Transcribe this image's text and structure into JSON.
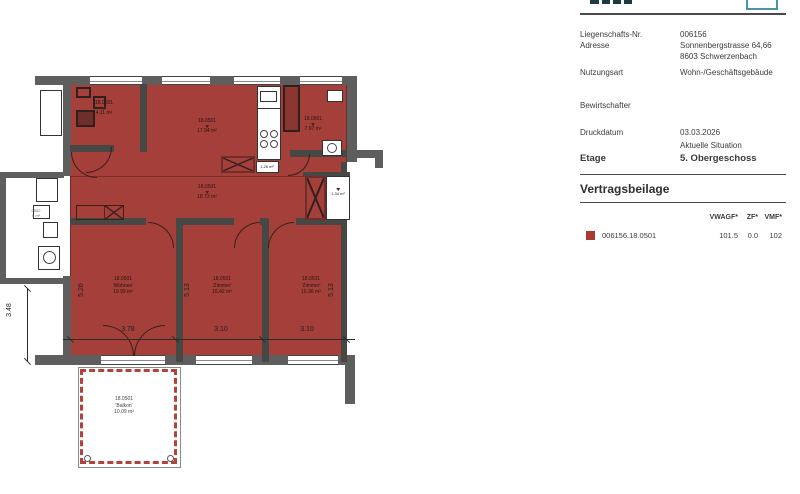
{
  "document": {
    "header": {
      "fields": [
        {
          "label": "Liegenschafts-Nr.",
          "value": "006156",
          "value2": ""
        },
        {
          "label": "Adresse",
          "value": "Sonnenbergstrasse 64,66",
          "value2": "8603 Schwerzenbach"
        },
        {
          "label": "Nutzungsart",
          "value": "Wohn-/Geschäftsgebäude",
          "value2": ""
        },
        {
          "label": "Bewirtschafter",
          "value": "",
          "value2": ""
        },
        {
          "label": "Druckdatum",
          "value": "03.03.2026",
          "value2": "Aktuelle Situation"
        }
      ],
      "etage_label": "Etage",
      "etage_value": "5. Obergeschoss"
    },
    "section_title": "Vertragsbeilage",
    "table": {
      "headers": {
        "vwagf": "VWAGF*",
        "zf": "ZF*",
        "vmf": "VMF*"
      },
      "row": {
        "id": "006156.18.0501",
        "vwagf": "101.5",
        "zf": "0.0",
        "vmf": "102"
      }
    }
  },
  "plan": {
    "labels": [
      {
        "unit": "18.0501",
        "name": "",
        "area": "4.11 m²"
      },
      {
        "unit": "18.0501",
        "name": "",
        "area": "17.94 m²"
      },
      {
        "unit": "18.0501",
        "name": "",
        "area": "7.97 m²"
      },
      {
        "unit": "",
        "name": "",
        "area": "1.26 m²"
      },
      {
        "unit": "18.0501",
        "name": "",
        "area": "18.73 m²"
      },
      {
        "unit": "",
        "name": "",
        "area": "1.34 m²"
      },
      {
        "unit": "18.0501",
        "name": "'Wohnen'",
        "area": "19.99 m²"
      },
      {
        "unit": "18.0501",
        "name": "'Zimmer'",
        "area": "16.42 m²"
      },
      {
        "unit": "18.0501",
        "name": "'Zimmer'",
        "area": "16.36 m²"
      },
      {
        "unit": "18.0501",
        "name": "'Balkon'",
        "area": "10.09 m²"
      },
      {
        "unit": "0502",
        "name": "",
        "area": "0 m²"
      }
    ],
    "dimensions": {
      "left_height": "3.48",
      "wohnen_height": "5.26",
      "zimmer1_height": "5.13",
      "zimmer2_height": "5.13",
      "wohnen_width": "3.78",
      "zimmer1_width": "3.10",
      "zimmer2_width": "3.10"
    }
  },
  "colors": {
    "unit_fill": "#a43f3a",
    "unit_wall": "#474744",
    "outer_wall": "#5e5e5e",
    "accent_teal": "#4e93a3",
    "swatch_red": "#a93a31"
  }
}
